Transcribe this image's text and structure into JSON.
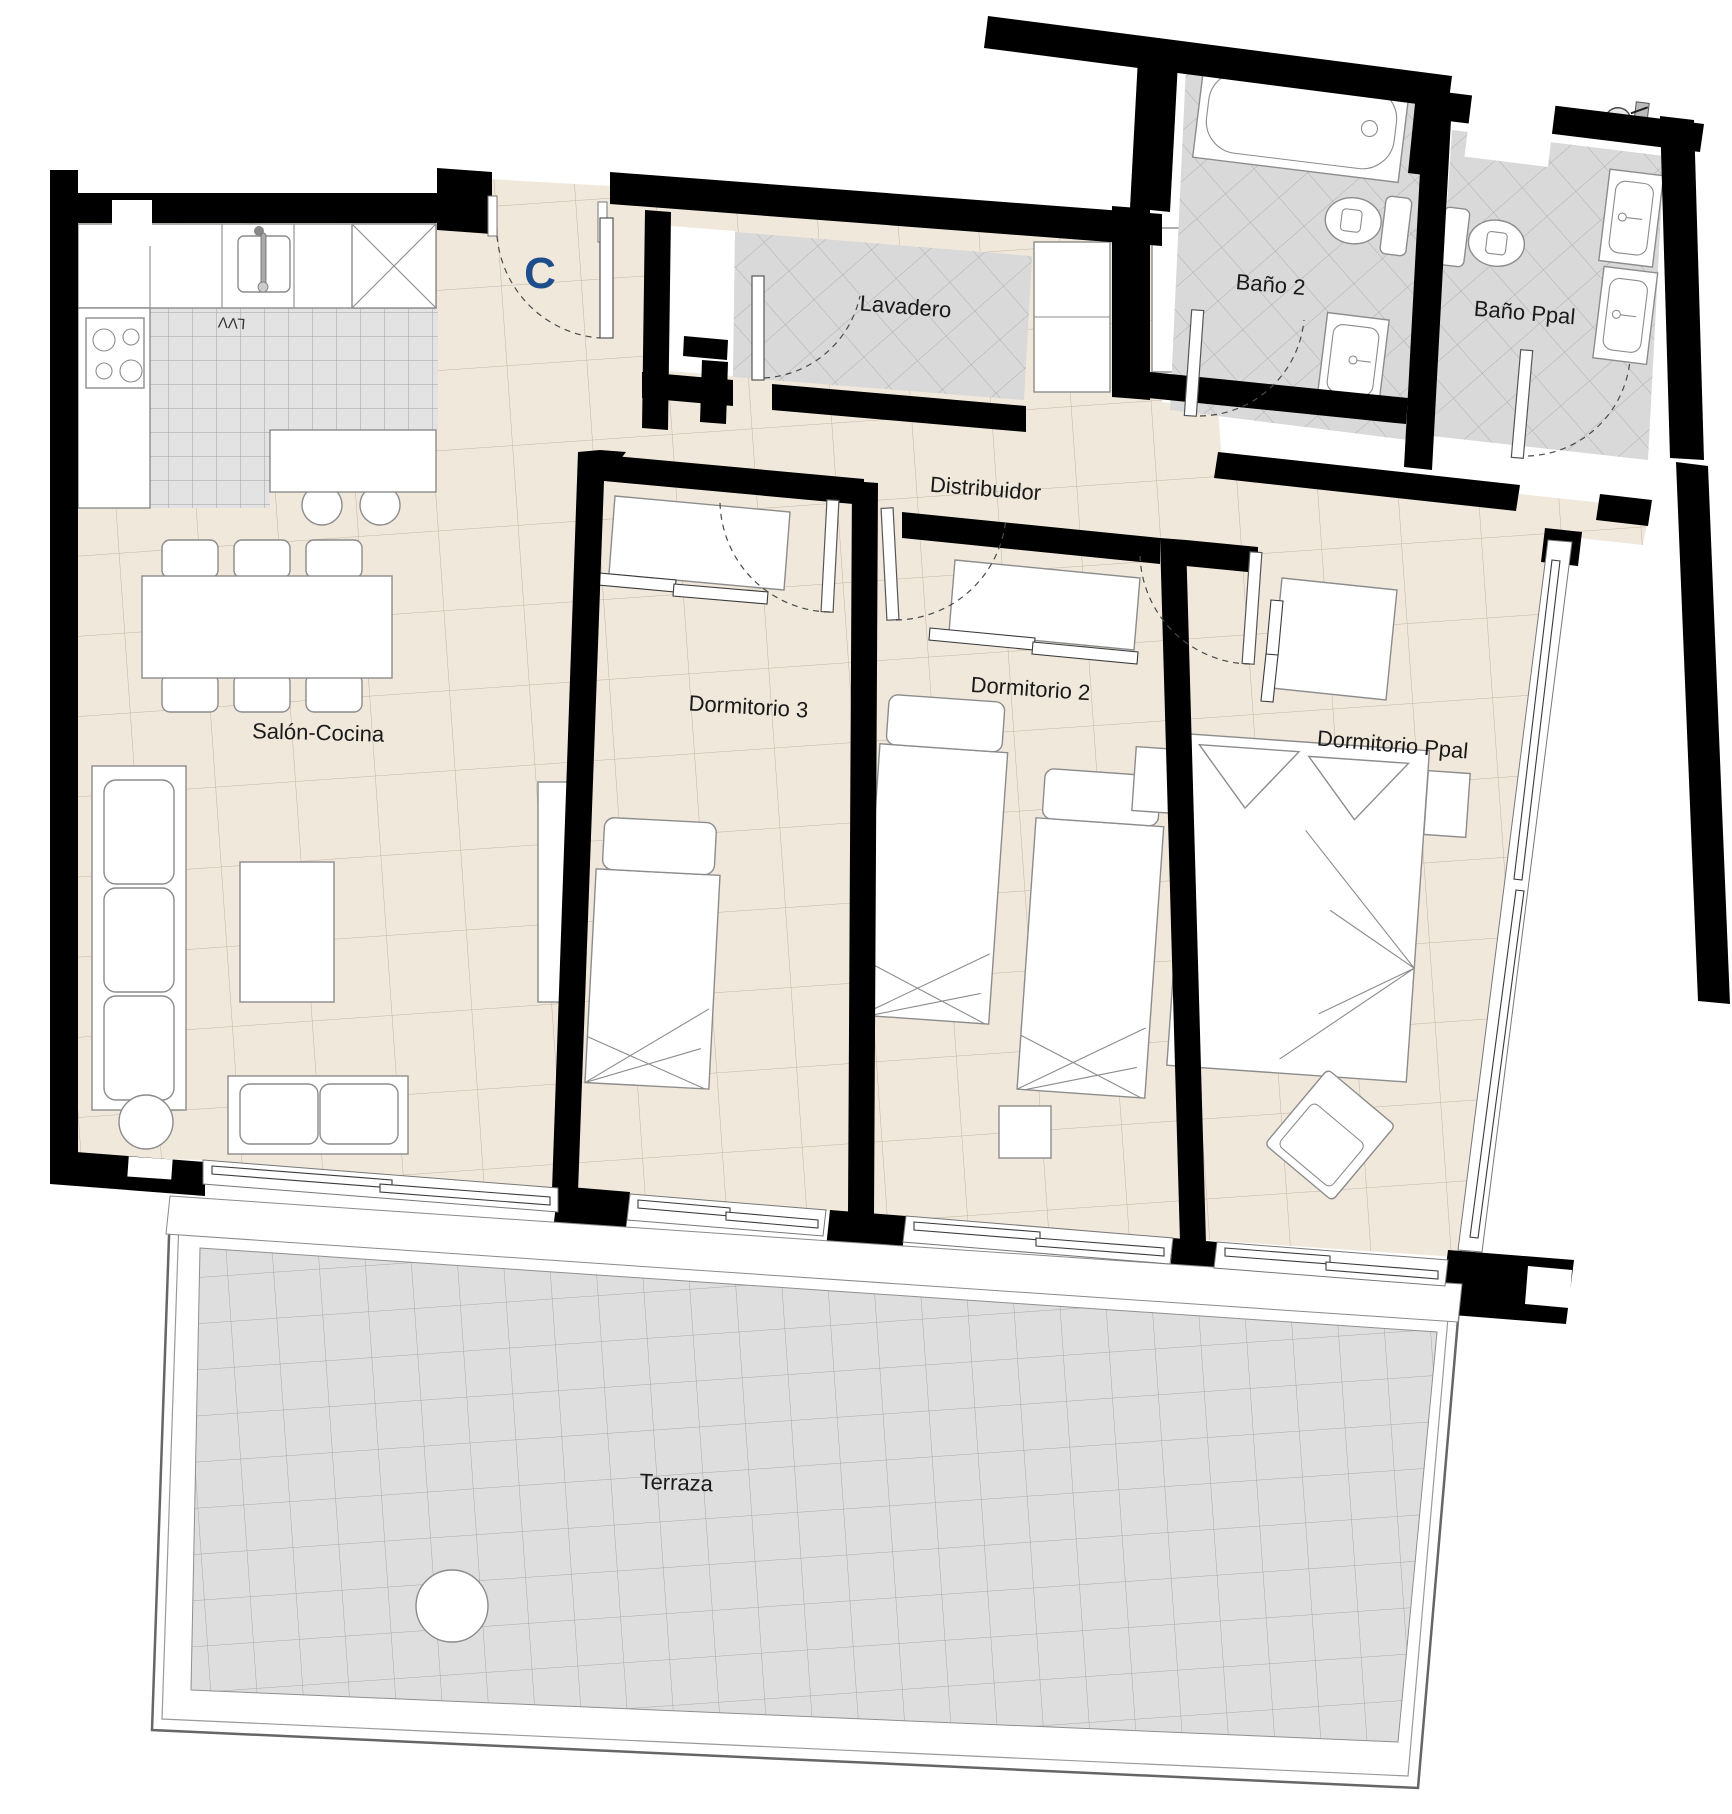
{
  "unit": {
    "letter": "C",
    "letter_color": "#1d4e8b"
  },
  "rooms": {
    "salon": {
      "label": "Salón-Cocina"
    },
    "dormitorio3": {
      "label": "Dormitorio 3"
    },
    "dormitorio2": {
      "label": "Dormitorio 2"
    },
    "dormitorioPpal": {
      "label": "Dormitorio Ppal"
    },
    "distribuidor": {
      "label": "Distribuidor"
    },
    "lavadero": {
      "label": "Lavadero"
    },
    "bano2": {
      "label": "Baño 2"
    },
    "banoPpal": {
      "label": "Baño Ppal"
    },
    "terraza": {
      "label": "Terraza"
    }
  },
  "appliances": {
    "dishwasher_label": "LVV"
  },
  "palette": {
    "wall": "#000000",
    "floor": "#f0e8db",
    "floor_line": "#c2b5a3",
    "wet_floor": "#d9d9d9",
    "wet_line": "#afafaf",
    "kitchen_floor": "#e3e3e3",
    "kitchen_line": "#a0a0a0",
    "terrace_floor": "#dedede",
    "terrace_line": "#a8a8a8",
    "furniture": "#8c8c8c",
    "door": "#4a4a4a",
    "accent": "#1d4e8b",
    "label": "#1a1a1a"
  }
}
